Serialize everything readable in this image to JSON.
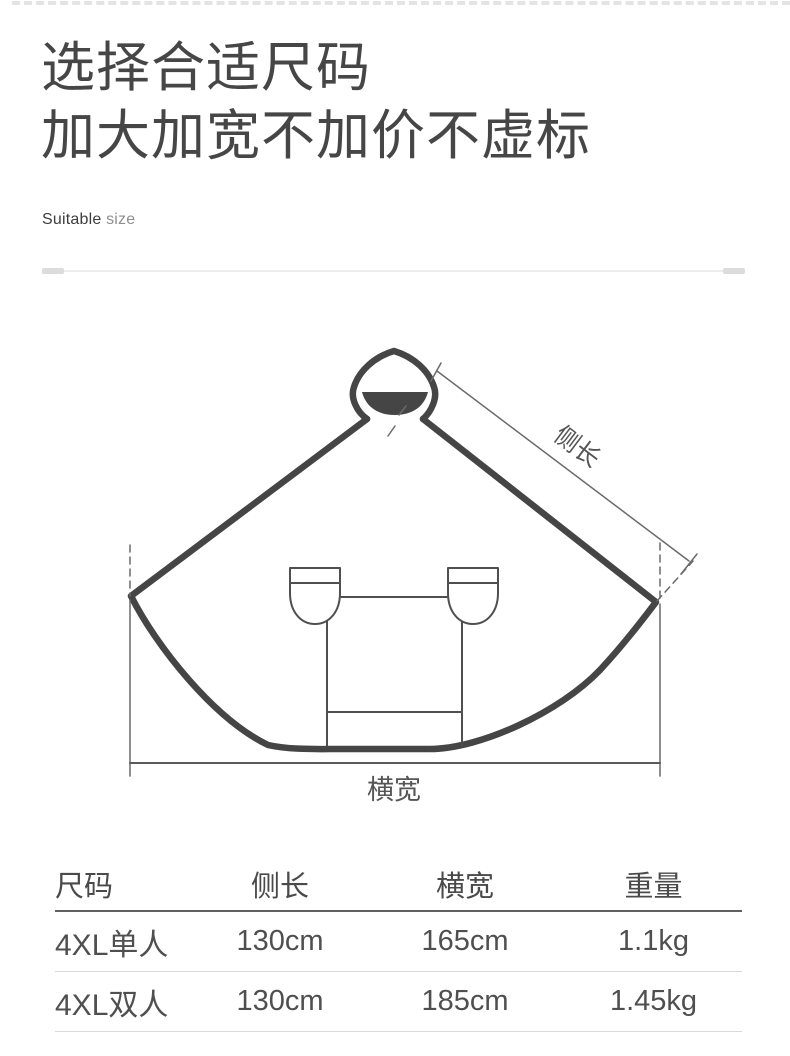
{
  "header": {
    "title_line1": "选择合适尺码",
    "title_line2": "加大加宽不加价不虚标",
    "subtitle_word1": "Suitable",
    "subtitle_word2": "size"
  },
  "diagram": {
    "label_side_length": "侧长",
    "label_width": "横宽"
  },
  "size_table": {
    "columns": {
      "size": "尺码",
      "side_length": "侧长",
      "width": "横宽",
      "weight": "重量"
    },
    "rows": [
      {
        "size": "4XL单人",
        "side_length": "130cm",
        "width": "165cm",
        "weight": "1.1kg"
      },
      {
        "size": "4XL双人",
        "side_length": "130cm",
        "width": "185cm",
        "weight": "1.45kg"
      }
    ]
  },
  "colors": {
    "heading_text": "#464646",
    "drawing_stroke": "#454545",
    "dimension_stroke": "#6a6a6a",
    "table_rule_dark": "#606060",
    "table_rule_light": "#d9d9d9"
  }
}
